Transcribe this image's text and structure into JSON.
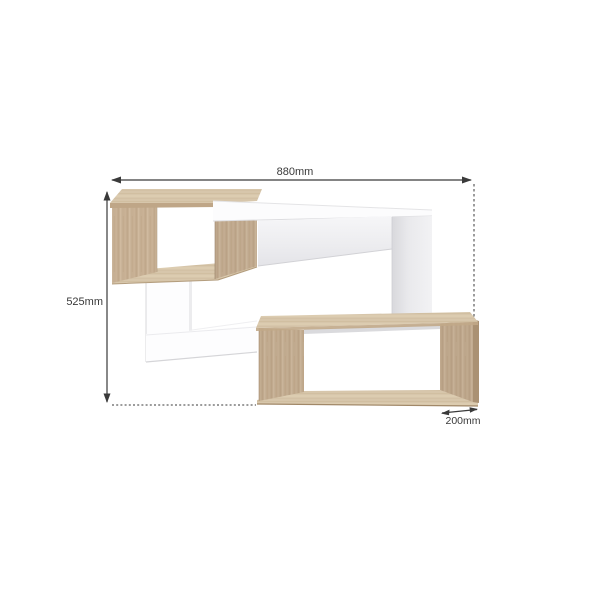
{
  "dimensions": {
    "width_label": "880mm",
    "height_label": "525mm",
    "depth_label": "200mm"
  },
  "colors": {
    "oak": "#c6af93",
    "oak_light": "#d7c6ab",
    "oak_dark": "#aa9173",
    "oak_edge": "#b59c7d",
    "panel_white": "#fdfdfe",
    "panel_shade": "#e2e2e6",
    "interior_shadow": "#d4d4d7",
    "dimension": "#3a3a3a",
    "background": "#ffffff"
  }
}
